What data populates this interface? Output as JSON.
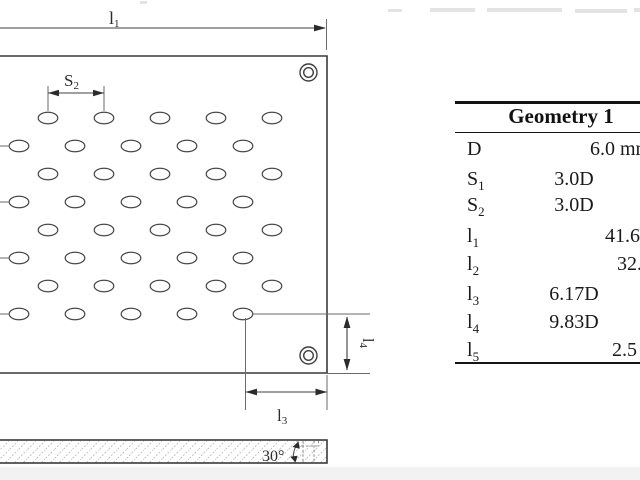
{
  "diagram": {
    "dim_l1": {
      "base": "l",
      "sub": "1"
    },
    "dim_s2": {
      "base": "S",
      "sub": "2"
    },
    "dim_l3": {
      "base": "l",
      "sub": "3"
    },
    "dim_l4": {
      "base": "l",
      "sub": "4"
    },
    "section_angle_label": "30°",
    "hole_pattern": {
      "rows": 8,
      "holes_per_row": 5
    }
  },
  "table": {
    "title": "Geometry 1",
    "rows": [
      {
        "param_base": "D",
        "param_sub": "",
        "value_d": "",
        "value_abs": "6.0 mm"
      },
      {
        "param_base": "S",
        "param_sub": "1",
        "value_d": "3.0D",
        "value_abs": ""
      },
      {
        "param_base": "S",
        "param_sub": "2",
        "value_d": "3.0D",
        "value_abs": ""
      },
      {
        "param_base": "l",
        "param_sub": "1",
        "value_d": "",
        "value_abs": "41.6"
      },
      {
        "param_base": "l",
        "param_sub": "2",
        "value_d": "",
        "value_abs": "32."
      },
      {
        "param_base": "l",
        "param_sub": "3",
        "value_d": "6.17D",
        "value_abs": ""
      },
      {
        "param_base": "l",
        "param_sub": "4",
        "value_d": "9.83D",
        "value_abs": ""
      },
      {
        "param_base": "l",
        "param_sub": "5",
        "value_d": "",
        "value_abs": "2.5"
      }
    ]
  }
}
